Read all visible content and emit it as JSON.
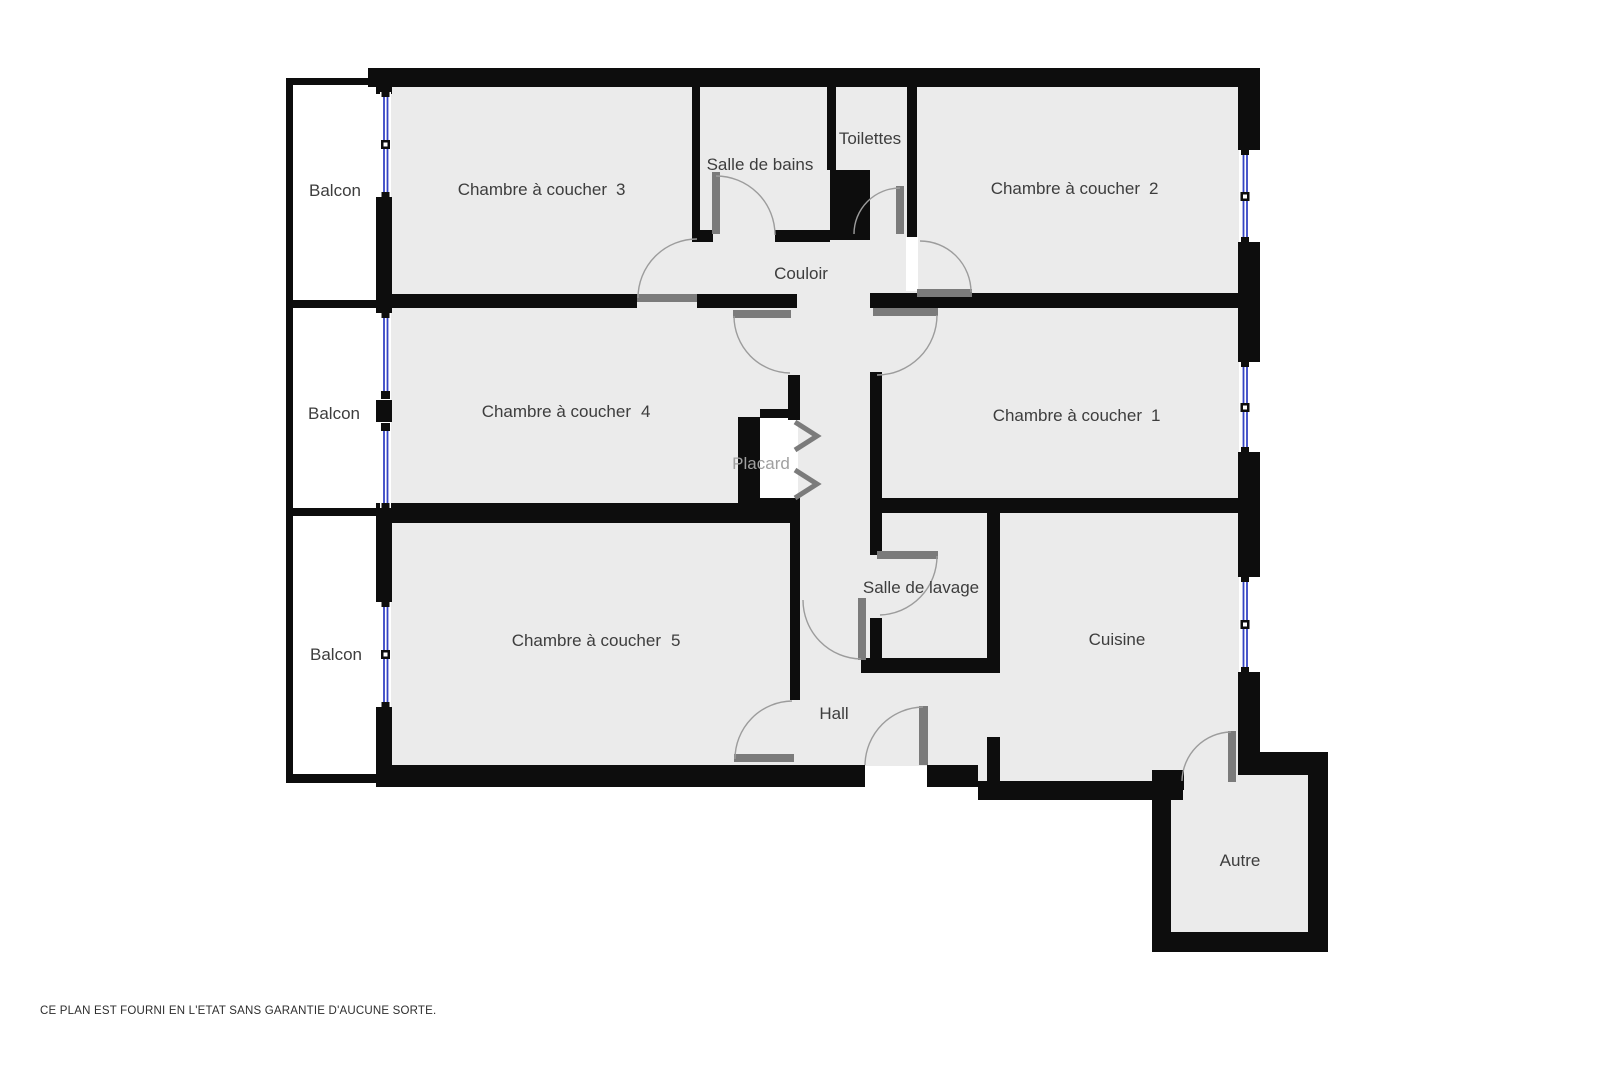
{
  "rooms": {
    "balcon_1": {
      "label": "Balcon"
    },
    "balcon_2": {
      "label": "Balcon"
    },
    "balcon_3": {
      "label": "Balcon"
    },
    "chambre_1": {
      "label": "Chambre à coucher",
      "num": "1"
    },
    "chambre_2": {
      "label": "Chambre à coucher",
      "num": "2"
    },
    "chambre_3": {
      "label": "Chambre à coucher",
      "num": "3"
    },
    "chambre_4": {
      "label": "Chambre à coucher",
      "num": "4"
    },
    "chambre_5": {
      "label": "Chambre à coucher",
      "num": "5"
    },
    "salle_de_bains": {
      "label": "Salle de bains"
    },
    "toilettes": {
      "label": "Toilettes"
    },
    "couloir": {
      "label": "Couloir"
    },
    "placard": {
      "label": "Placard"
    },
    "salle_de_lavage": {
      "label": "Salle de lavage"
    },
    "cuisine": {
      "label": "Cuisine"
    },
    "hall": {
      "label": "Hall"
    },
    "autre": {
      "label": "Autre"
    }
  },
  "footer": {
    "disclaimer": "CE PLAN EST FOURNI EN L'ETAT SANS GARANTIE D'AUCUNE SORTE."
  },
  "colors": {
    "wall": "#0d0d0d",
    "floor": "#ebebeb",
    "balcony_floor": "#ffffff",
    "door_leaf": "#7b7b7b",
    "door_arc": "#9c9c9c",
    "window_glass": "#3544c4",
    "label_text": "#3d3d3d",
    "muted_label": "#a0a0a0"
  }
}
